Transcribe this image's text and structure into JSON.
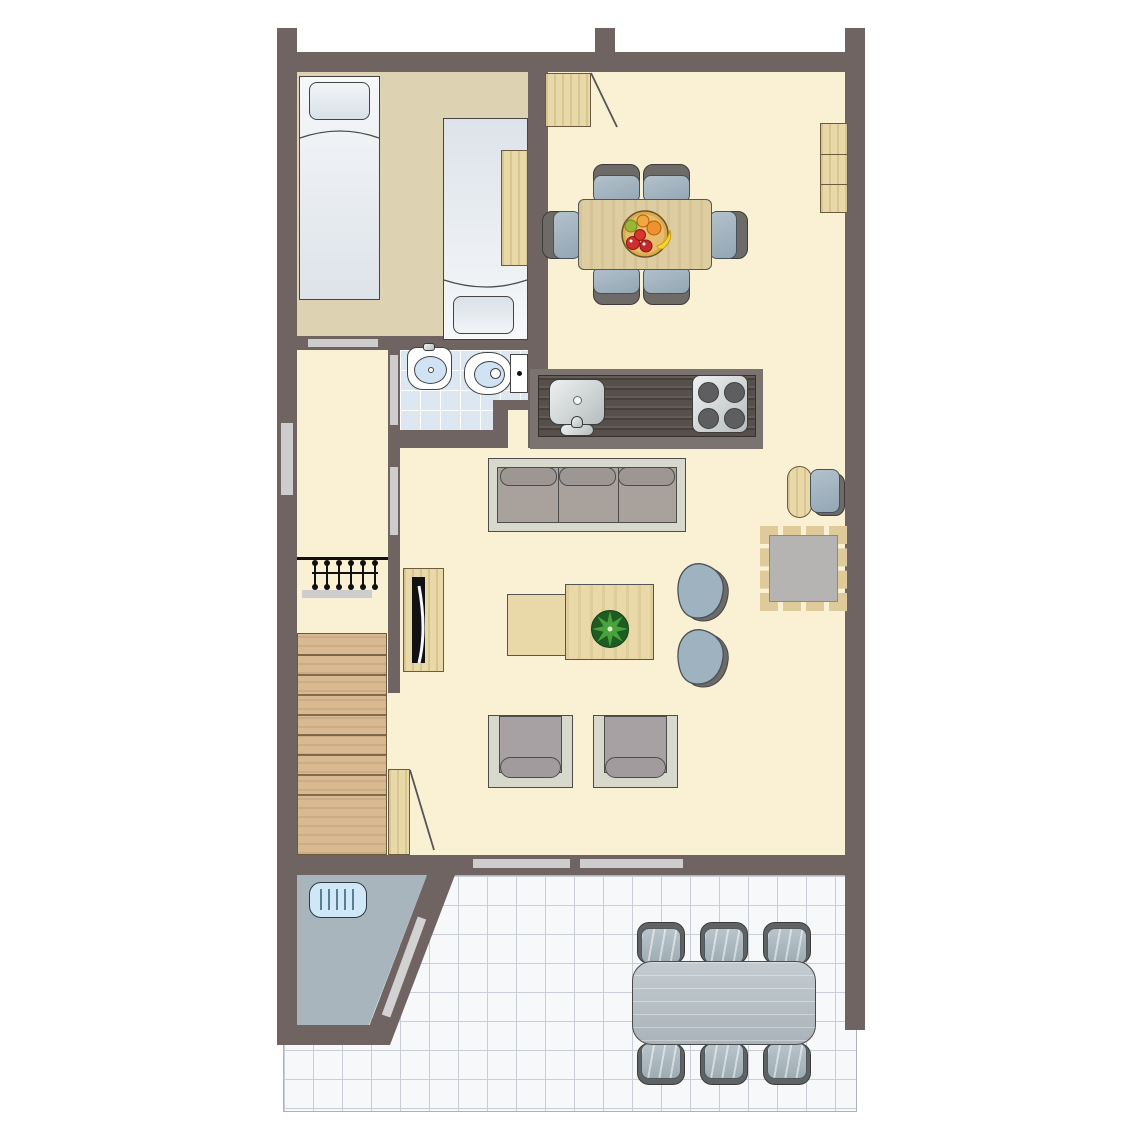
{
  "meta": {
    "description": "Top-down 2D architectural floor plan of a holiday home: bedroom with two single beds, open dining/kitchen/living area, bathroom, hallway with coat rack, staircase, exterior storage room and tiled terrace with outdoor dining set",
    "visible_text": "none"
  },
  "palette": {
    "background": "#ffffff",
    "wall": "#6f6462",
    "bedroom_floor": "#ddd3b2",
    "main_floor": "#faf0d4",
    "bath_tile": "#dce7f2",
    "bath_grout": "#ffffff",
    "terrace_tile": "#f7f8fa",
    "terrace_line": "#c9cdd6",
    "storage_floor": "#a9b5bd",
    "wood": "#e9d9a9",
    "wood_table": "#ddcda1",
    "stairs_wood": "#d8b992",
    "counter_wood": "#564f4a",
    "sofa_frame": "#d6d9cb",
    "cushion_gray": "#a8a19c",
    "chair_dark": "#6d6a68",
    "chair_blue": "#a3b4c1",
    "rug_center": "#b5b4b2",
    "rug_fringe": "#dfca9a",
    "threshold_gray": "#cdcdcd",
    "fixture_white": "#ffffff",
    "water_blue": "#cfe3f4",
    "grate_blue": "#cfe7f7",
    "tv_black": "#111111",
    "plant_green_dark": "#1e5c23",
    "plant_green": "#49a33b",
    "terrace_table_gray": "#b6c0c6"
  },
  "rooms": [
    {
      "name": "bedroom",
      "floor": "tan"
    },
    {
      "name": "dining-area",
      "floor": "cream"
    },
    {
      "name": "kitchen",
      "floor": "cream"
    },
    {
      "name": "bathroom",
      "floor": "blue-tile"
    },
    {
      "name": "hallway",
      "floor": "cream"
    },
    {
      "name": "living-room",
      "floor": "cream"
    },
    {
      "name": "staircase",
      "floor": "wood"
    },
    {
      "name": "storage-room",
      "floor": "blue-gray"
    },
    {
      "name": "terrace",
      "floor": "white-tile"
    }
  ],
  "furniture": [
    "single-bed-left",
    "single-bed-right",
    "nightstand",
    "entry-door",
    "dining-table",
    "dining-chairs-x6",
    "fruit-bowl",
    "wall-cabinet",
    "kitchen-counter",
    "kitchen-sink",
    "stove-4-burners",
    "washbasin",
    "toilet",
    "coat-rack",
    "stairs",
    "understairs-door",
    "sofa-3-seat",
    "tv-stand",
    "tv",
    "coffee-table-set",
    "plant",
    "lounge-chairs-x2",
    "side-chair",
    "ottoman",
    "rug",
    "armchairs-x2",
    "floor-grate",
    "terrace-table",
    "terrace-chairs-x6"
  ]
}
